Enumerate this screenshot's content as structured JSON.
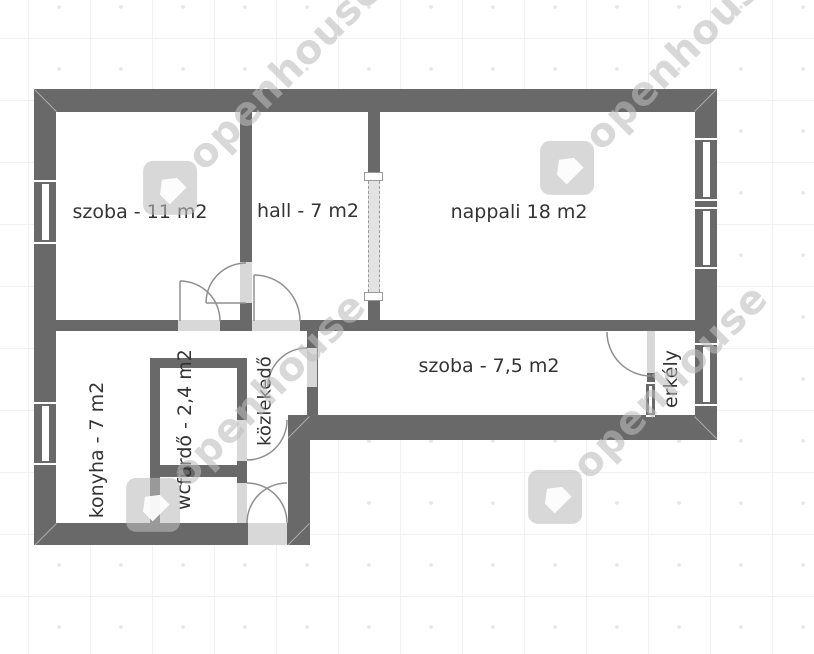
{
  "watermark": {
    "brand": "openhouse"
  },
  "rooms": {
    "szoba1": {
      "label": "szoba - 11 m2"
    },
    "hall": {
      "label": "hall - 7 m2"
    },
    "nappali": {
      "label": "nappali 18 m2"
    },
    "szoba2": {
      "label": "szoba - 7,5 m2"
    },
    "konyha": {
      "label": "konyha - 7 m2"
    },
    "furdo": {
      "label": "fürdő - 2,4 m2"
    },
    "wc": {
      "label": "wc"
    },
    "kozlekedo": {
      "label": "közlekedő"
    },
    "erkely": {
      "label": "erkély"
    }
  },
  "colors": {
    "wall": "#696969",
    "opening": "#d8d8d8",
    "label": "#333333",
    "grid": "#f1f1f1",
    "floor": "#ffffff",
    "arc": "#8f8f8f"
  }
}
